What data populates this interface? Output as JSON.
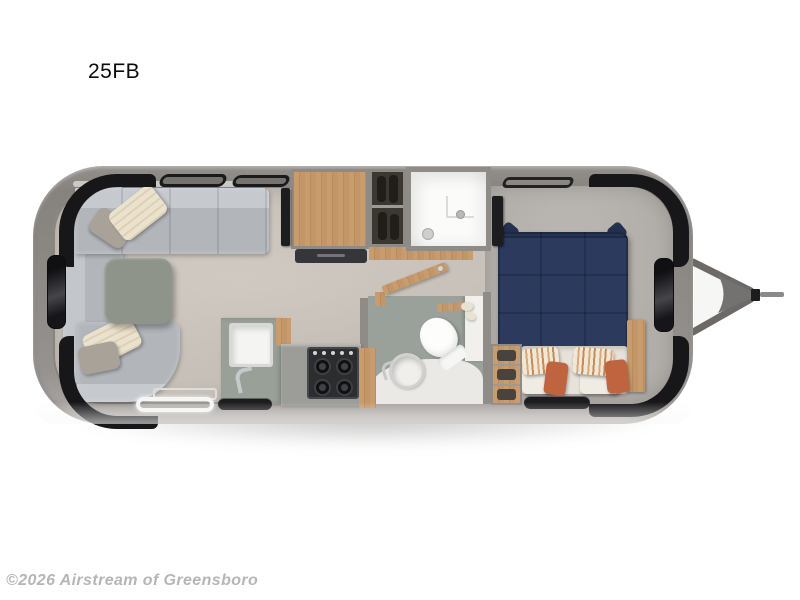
{
  "page": {
    "title_label": "25FB",
    "watermark": "©2026 Airstream of Greensboro",
    "background_color": "#ffffff"
  },
  "floorplan": {
    "model": "25FB",
    "view": "top-down travel trailer floorplan, hitch on right",
    "colors": {
      "shell": "#8d8985",
      "floor": "#c7c1b9",
      "bedroom_carpet": "#b1ada8",
      "sofa": "#b5b9be",
      "table": "#8f948b",
      "wood": "#c3966a",
      "bed_duvet": "#2c3a5e",
      "accent_pillow": "#c0643f",
      "cream_pillow": "#ebe2cd",
      "counter": "#99a098",
      "stove": "#2c2d2f",
      "window_glass": "#17171a"
    },
    "rooms": [
      "front-lounge",
      "galley-kitchen",
      "bathroom",
      "shower",
      "rear-bedroom"
    ],
    "furniture": [
      "wraparound-sofa",
      "throw-pillows",
      "dinette-table",
      "tv",
      "galley-cabinet",
      "hanging-wardrobe",
      "shower-stall",
      "kitchen-sink",
      "gas-stove",
      "bathroom-door",
      "toilet",
      "round-lavatory-sink",
      "queen-bed",
      "bed-pillows",
      "nightstand",
      "foot-wardrobe",
      "entry-door-step",
      "roof-vent",
      "wraparound-windows",
      "a-frame-hitch"
    ]
  }
}
